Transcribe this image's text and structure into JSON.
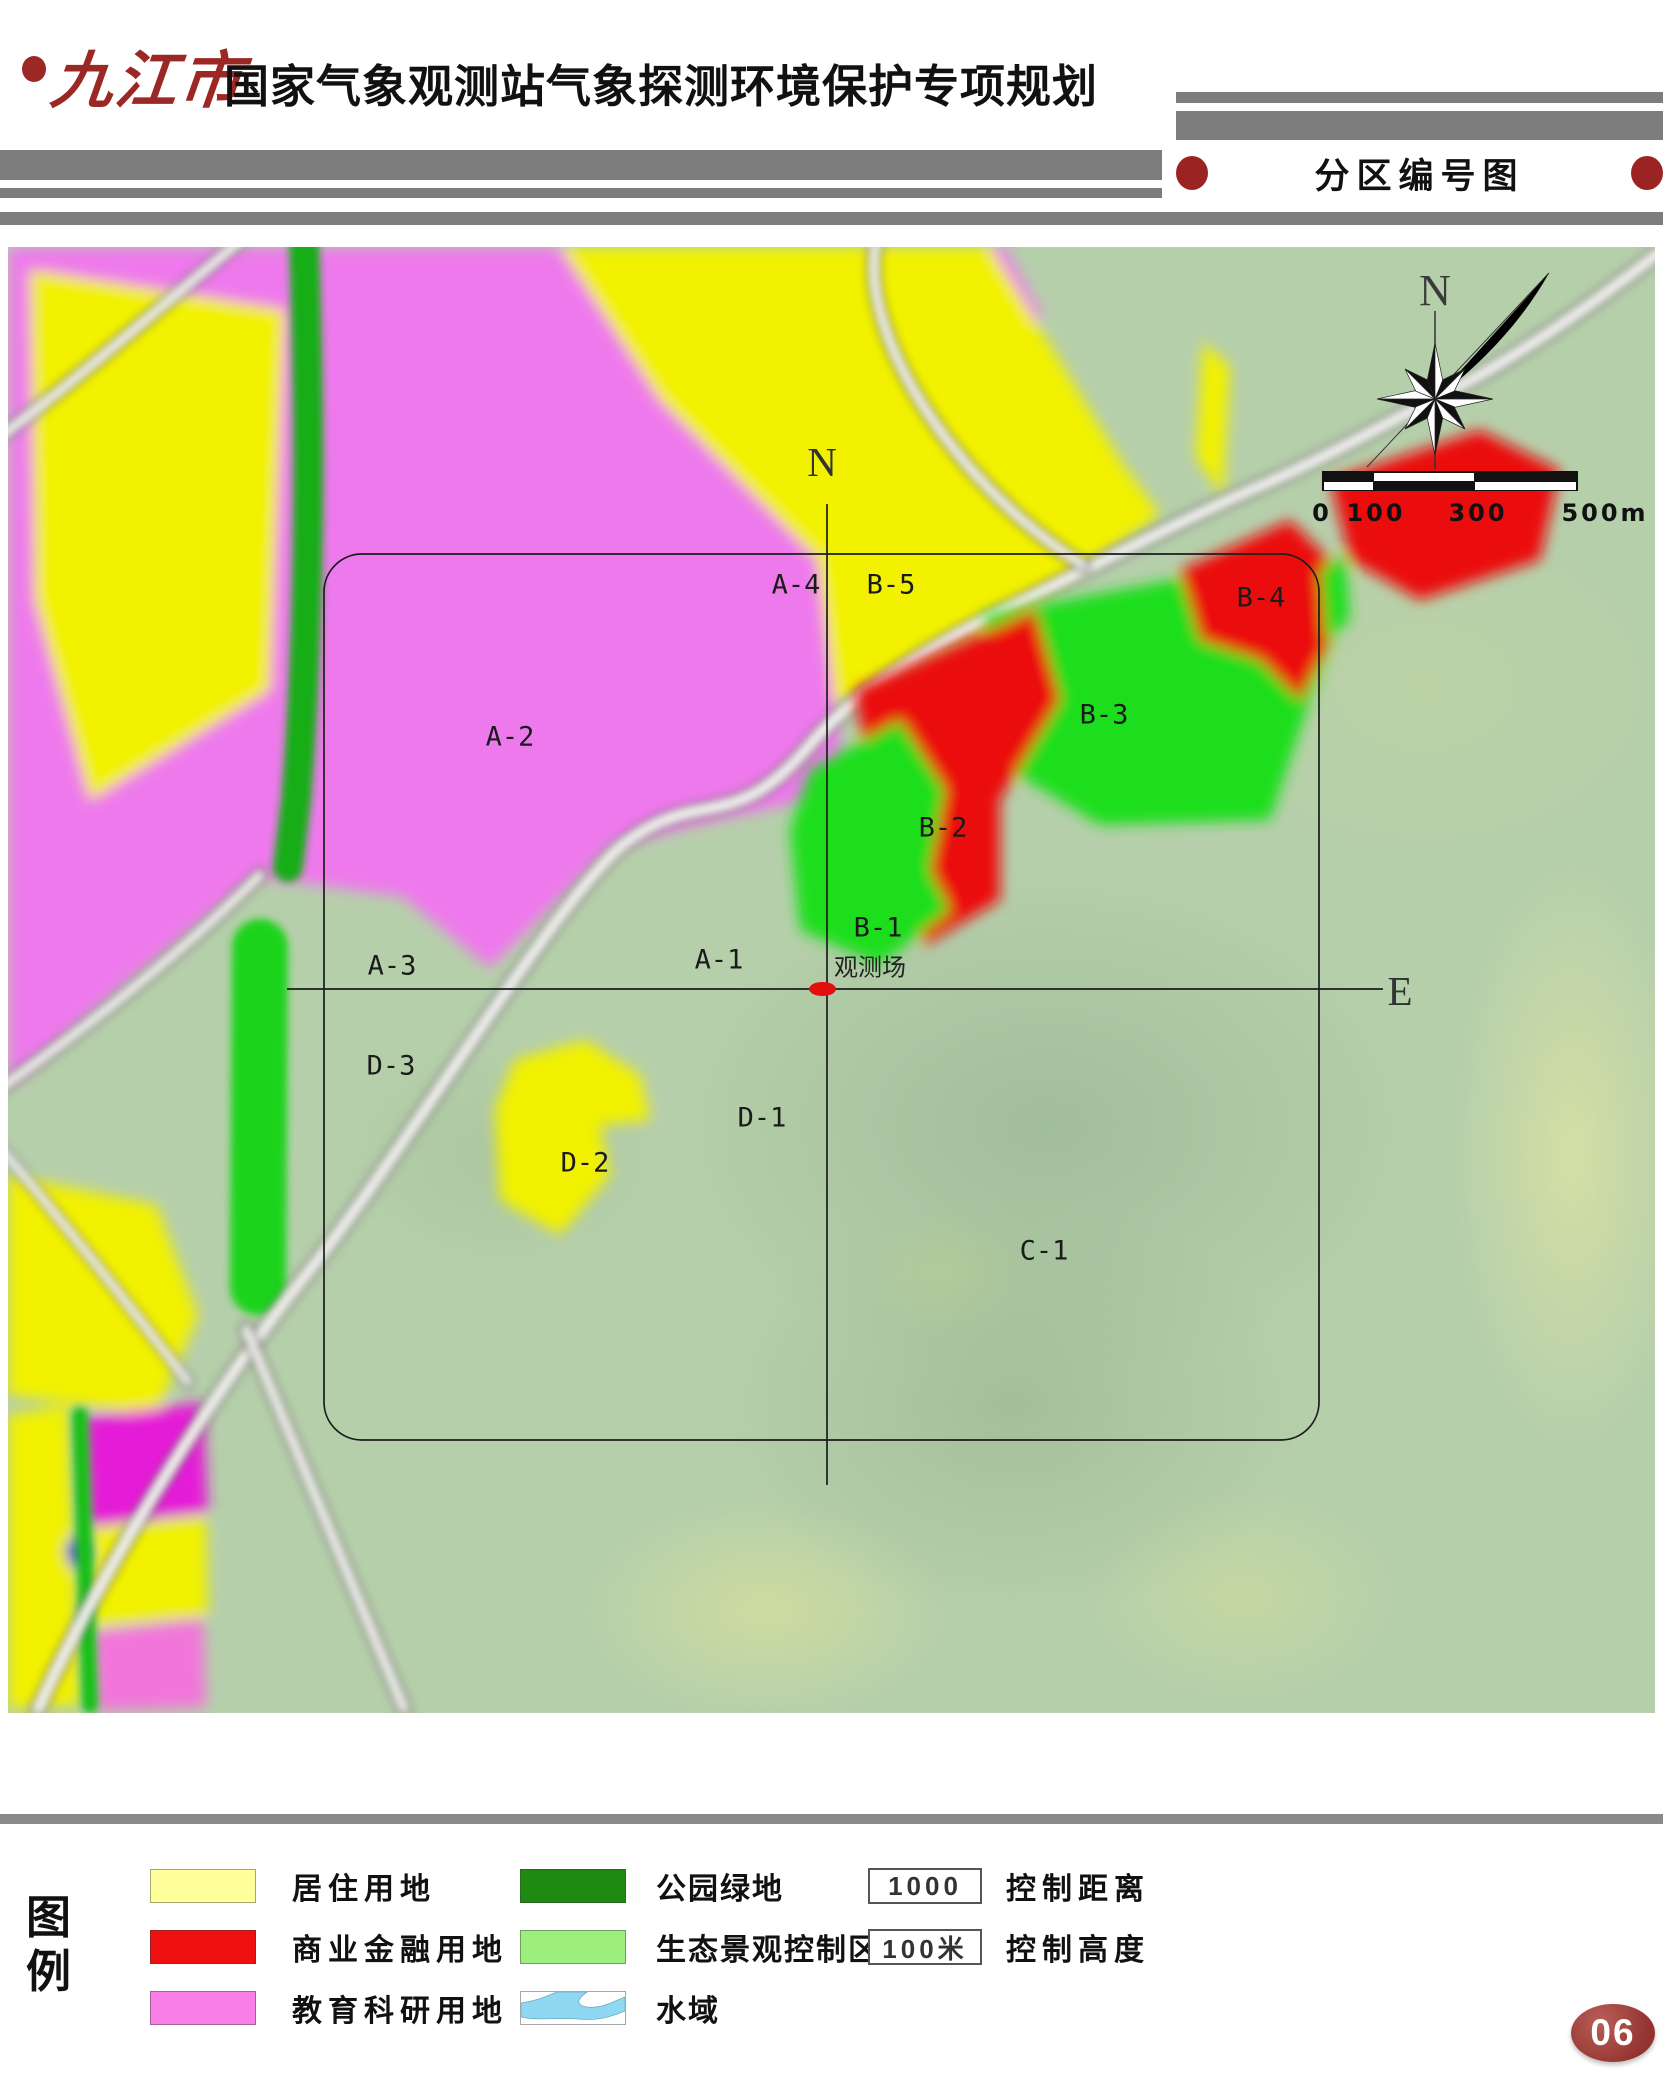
{
  "header": {
    "brand": "九江市",
    "title": "国家气象观测站气象探测环境保护专项规划",
    "section_title": "分区编号图"
  },
  "map": {
    "compass_label": "N",
    "labels": [
      {
        "id": "axis-n",
        "text": "N",
        "x": 814,
        "y": 215,
        "cls": "axis"
      },
      {
        "id": "axis-e",
        "text": "E",
        "x": 1392,
        "y": 744,
        "cls": "axis"
      },
      {
        "id": "zone-a2",
        "text": "A-2",
        "x": 502,
        "y": 490,
        "cls": "zone"
      },
      {
        "id": "zone-a4",
        "text": "A-4",
        "x": 788,
        "y": 338,
        "cls": "zone"
      },
      {
        "id": "zone-b5",
        "text": "B-5",
        "x": 883,
        "y": 338,
        "cls": "zone"
      },
      {
        "id": "zone-b4",
        "text": "B-4",
        "x": 1253,
        "y": 351,
        "cls": "zone"
      },
      {
        "id": "zone-b3",
        "text": "B-3",
        "x": 1096,
        "y": 468,
        "cls": "zone"
      },
      {
        "id": "zone-b2",
        "text": "B-2",
        "x": 935,
        "y": 581,
        "cls": "zone"
      },
      {
        "id": "zone-b1",
        "text": "B-1",
        "x": 870,
        "y": 681,
        "cls": "zone"
      },
      {
        "id": "zone-a3",
        "text": "A-3",
        "x": 384,
        "y": 719,
        "cls": "zone"
      },
      {
        "id": "zone-a1",
        "text": "A-1",
        "x": 711,
        "y": 713,
        "cls": "zone"
      },
      {
        "id": "zone-d3",
        "text": "D-3",
        "x": 383,
        "y": 819,
        "cls": "zone"
      },
      {
        "id": "zone-d1",
        "text": "D-1",
        "x": 754,
        "y": 871,
        "cls": "zone"
      },
      {
        "id": "zone-d2",
        "text": "D-2",
        "x": 577,
        "y": 916,
        "cls": "zone"
      },
      {
        "id": "zone-c1",
        "text": "C-1",
        "x": 1036,
        "y": 1004,
        "cls": "zone"
      },
      {
        "id": "station",
        "text": "观测场",
        "x": 862,
        "y": 718,
        "cls": "station"
      }
    ],
    "scalebar": {
      "seg_widths": [
        51,
        102,
        103
      ],
      "segments_top": [
        "#111111",
        "#ffffff",
        "#111111"
      ],
      "segments_bottom": [
        "#ffffff",
        "#111111",
        "#ffffff"
      ],
      "ticks": [
        {
          "t": "0",
          "x": 0
        },
        {
          "t": "100",
          "x": 54
        },
        {
          "t": "300",
          "x": 156
        },
        {
          "t": "500m",
          "x": 283
        }
      ]
    }
  },
  "legend": {
    "title": "图例",
    "land_items": [
      {
        "label": "居住用地",
        "color": "#ffff9b"
      },
      {
        "label": "商业金融用地",
        "color": "#ee0f0f"
      },
      {
        "label": "教育科研用地",
        "color": "#f97ee6"
      }
    ],
    "zone_items": [
      {
        "label": "公园绿地",
        "color": "#1f8a12"
      },
      {
        "label": "生态景观控制区",
        "color": "#9cee7d"
      },
      {
        "label": "水域",
        "color": "water"
      }
    ],
    "control_items": [
      {
        "value": "1000",
        "label": "控制距离"
      },
      {
        "value": "100米",
        "label": "控制高度"
      }
    ]
  },
  "page_number": "06",
  "colors": {
    "accent_red": "#9b2824",
    "bar_gray": "#7d7d7d",
    "map_pink": "#ee79ec",
    "map_yellow": "#f1f103",
    "map_green": "#1ede1e",
    "map_red": "#eb1111"
  }
}
